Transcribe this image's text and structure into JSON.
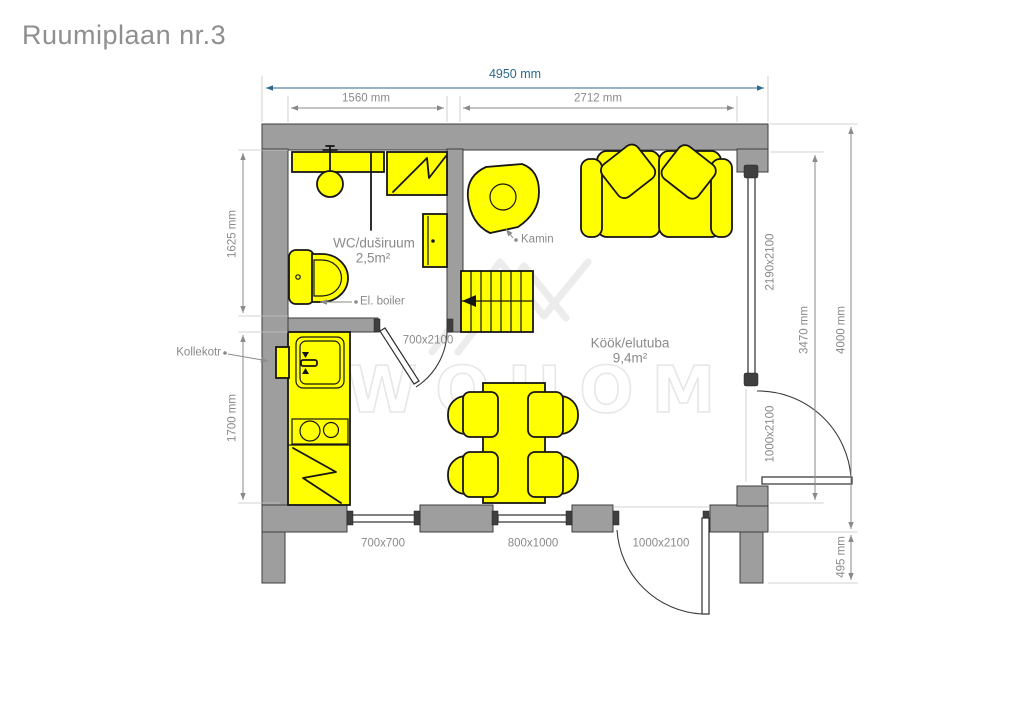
{
  "title": "Ruumiplaan nr.3",
  "watermark": "WOHOM",
  "colors": {
    "furniture": "#ffff00",
    "wall": "#9e9e9e",
    "dim-text": "#8a8a8a",
    "total-dim": "#2b6a8a",
    "watermark": "#ececec"
  },
  "rooms": {
    "wc": {
      "name": "WC/duširuum",
      "area": "2,5m²"
    },
    "living": {
      "name": "Köök/elutuba",
      "area": "9,4m²"
    }
  },
  "annotations": {
    "kamin": "Kamin",
    "boiler": "El. boiler",
    "kollektor": "Kollekotr"
  },
  "dims": {
    "total_width": "4950 mm",
    "wc_width": "1560 mm",
    "living_width": "2712 mm",
    "wc_height": "1625 mm",
    "kitchen_height": "1700 mm",
    "east_inner_height": "3470 mm",
    "total_height": "4000 mm",
    "foundation": "495 mm"
  },
  "openings": {
    "interior_door": "700x2100",
    "window_small": "700x700",
    "window_mid": "800x1000",
    "door_south": "1000x2100",
    "glazing_east": "2190x2100",
    "door_east": "1000x2100"
  }
}
